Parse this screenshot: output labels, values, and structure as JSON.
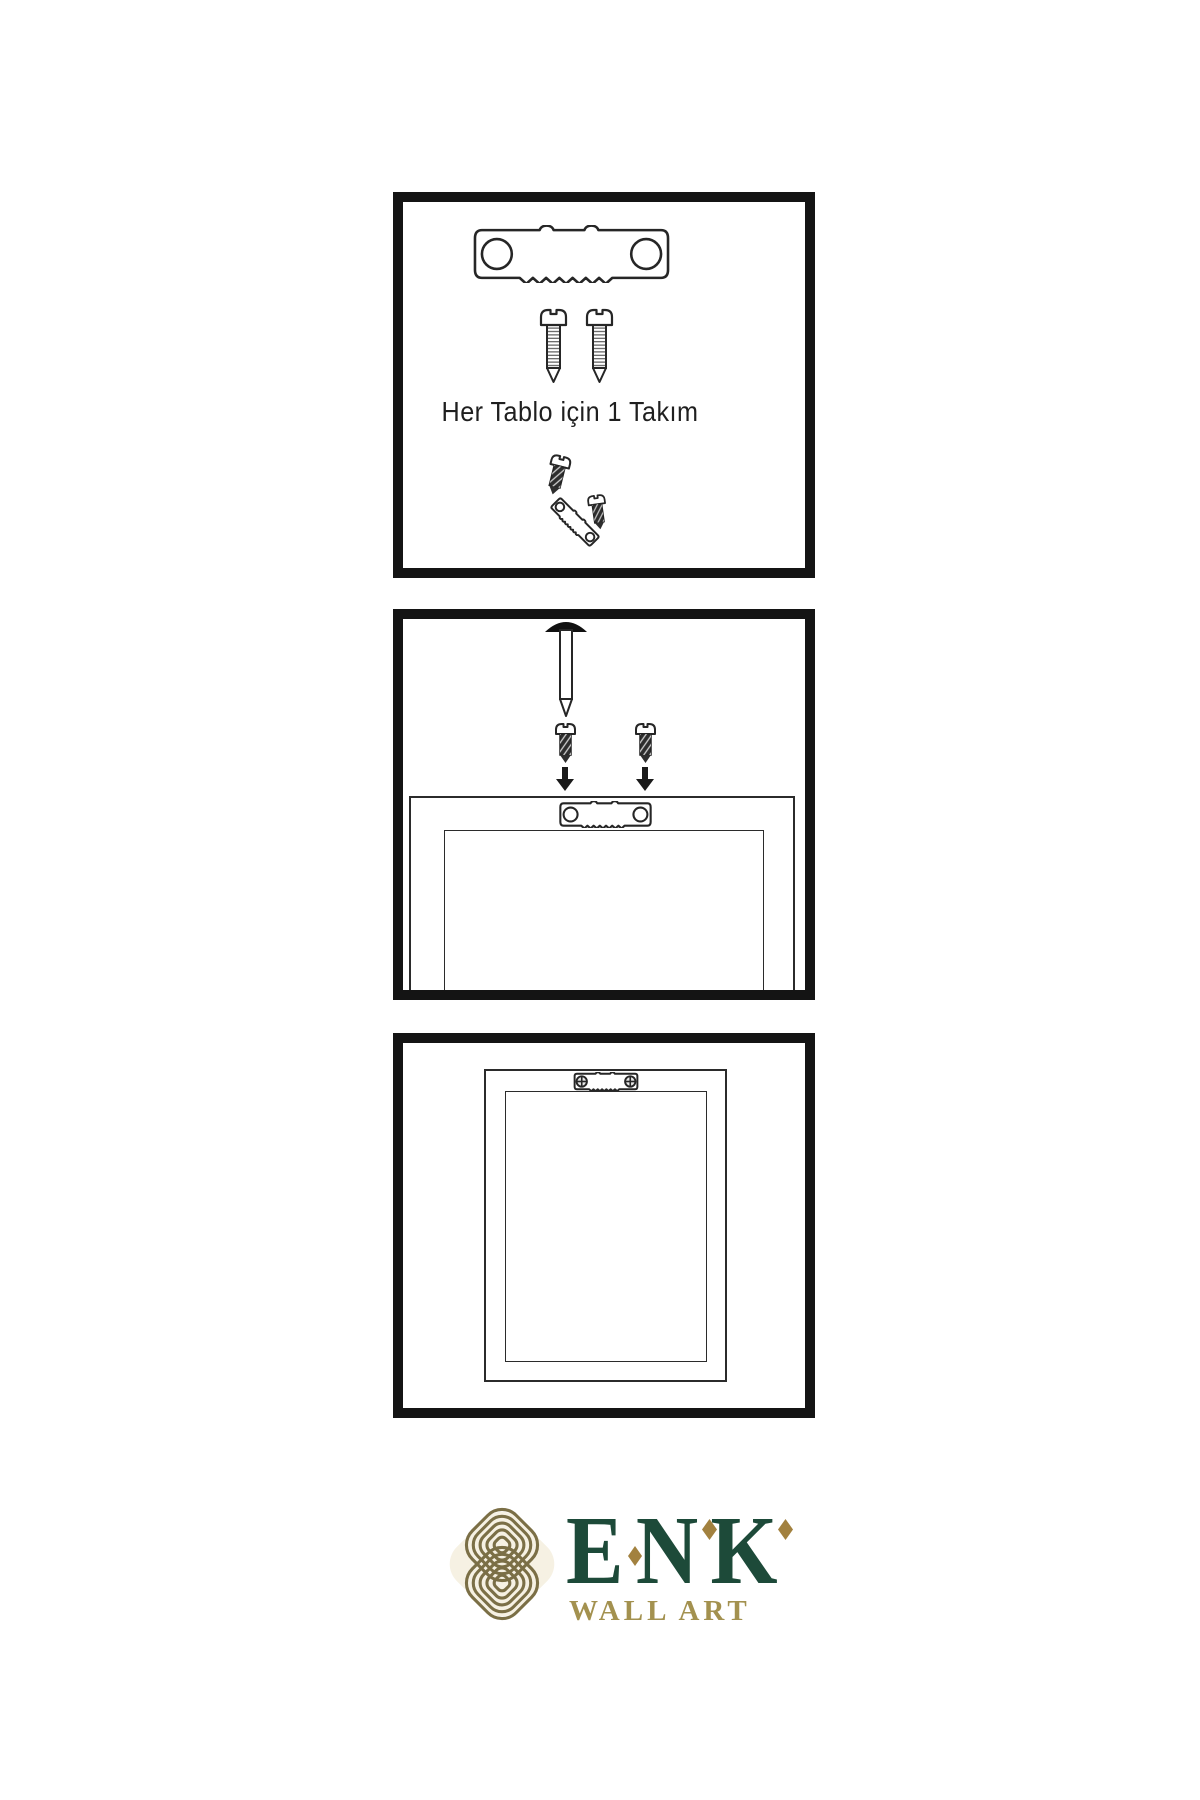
{
  "page": {
    "type": "wall-art-hanging-instructions",
    "background_color": "#ffffff",
    "line_color": "#262626"
  },
  "steps": [
    {
      "caption": "Her Tablo için 1 Takım",
      "icons": [
        "sawtooth-hanger-icon",
        "screw-icon",
        "screw-icon",
        "screw-dark-icon",
        "sawtooth-hanger-angled-icon",
        "screw-dark-icon"
      ]
    },
    {
      "caption": "",
      "icons": [
        "wall-nail-icon",
        "screw-dark-icon",
        "screw-dark-icon",
        "arrow-down-icon",
        "arrow-down-icon",
        "frame-back-icon",
        "sawtooth-hanger-small-icon"
      ]
    },
    {
      "caption": "",
      "icons": [
        "hung-frame-icon",
        "sawtooth-hanger-screwed-icon"
      ]
    }
  ],
  "brand": {
    "name": "ENK",
    "subtitle": "WALL ART",
    "emblem": "knot-emblem-icon",
    "colors": {
      "name_green": "#1d4a39",
      "diamond_gold": "#a2813f",
      "subtitle_gold": "#a3914f",
      "emblem_gold": "#7b6f46",
      "emblem_cream": "#f6f1e3"
    }
  }
}
